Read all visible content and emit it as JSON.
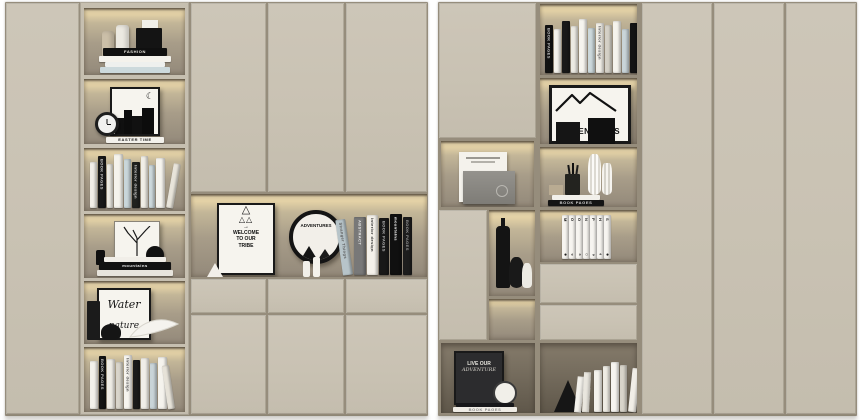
{
  "scene": {
    "background_color": "#ffffff",
    "cabinet_color": "#c9c2b3",
    "led_color": "#f0dcа4",
    "niche_back_color": "#a89d89",
    "dark_niche_color": "#6f6759",
    "book_black": "#161616",
    "book_white": "#f3f1ea",
    "book_blue": "#c7d4d8"
  },
  "left_unit": {
    "niche1": {
      "stack": [
        {
          "w": 64,
          "h": 8,
          "c": "#101010",
          "t": "FASHION",
          "tc": "#ece9e1"
        },
        {
          "w": 72,
          "h": 6,
          "c": "#f4f2ec"
        },
        {
          "w": 60,
          "h": 5,
          "c": "#eef0ee"
        },
        {
          "w": 70,
          "h": 6,
          "c": "#ccd9dc"
        }
      ]
    },
    "niche2": {
      "stack": [
        {
          "w": 58,
          "h": 6,
          "c": "#f3f1eb",
          "t": "EASTER TIME",
          "tc": "#1c1c1c"
        }
      ]
    },
    "niche3": {
      "books": [
        {
          "w": 7,
          "h": 46,
          "c": "#f2efe8"
        },
        {
          "w": 8,
          "h": 52,
          "c": "#191919",
          "t": "BOOK PAGES",
          "tc": "#cfcfcf"
        },
        {
          "w": 6,
          "h": 44,
          "c": "#eceae2"
        },
        {
          "w": 9,
          "h": 54,
          "c": "#f5f3ec"
        },
        {
          "w": 7,
          "h": 49,
          "c": "#c9d6da"
        },
        {
          "w": 8,
          "h": 46,
          "c": "#20221f",
          "t": "Interior design",
          "tc": "#d8d8d8"
        },
        {
          "w": 7,
          "h": 52,
          "c": "#f1eee6"
        },
        {
          "w": 6,
          "h": 43,
          "c": "#cdd9dc"
        },
        {
          "w": 9,
          "h": 50,
          "c": "#f6f4ee"
        },
        {
          "w": 7,
          "h": 45,
          "c": "#e8e4da",
          "lean": 10
        }
      ]
    },
    "niche4": {
      "stack": [
        {
          "w": 62,
          "h": 5,
          "c": "#f1eee8"
        },
        {
          "w": 72,
          "h": 8,
          "c": "#121212",
          "t": "mountains",
          "tc": "#f5f5f5"
        },
        {
          "w": 76,
          "h": 6,
          "c": "#e7e4dc"
        }
      ]
    },
    "niche5": {
      "art": {
        "line1": "Water",
        "line2": "nature"
      }
    },
    "niche6": {
      "books": [
        {
          "w": 8,
          "h": 48,
          "c": "#f3f1eb"
        },
        {
          "w": 7,
          "h": 53,
          "c": "#141414",
          "t": "BOOK PAGES",
          "tc": "#c9c9c9"
        },
        {
          "w": 8,
          "h": 50,
          "c": "#efece5"
        },
        {
          "w": 7,
          "h": 47,
          "c": "#d9d5cb"
        },
        {
          "w": 8,
          "h": 54,
          "c": "#f6f4ef",
          "t": "Interior design",
          "tc": "#444444"
        },
        {
          "w": 7,
          "h": 49,
          "c": "#1b1b1b"
        },
        {
          "w": 8,
          "h": 51,
          "c": "#f1eee8"
        },
        {
          "w": 7,
          "h": 46,
          "c": "#c9d4d8"
        },
        {
          "w": 9,
          "h": 52,
          "c": "#f5f3ed"
        },
        {
          "w": 7,
          "h": 44,
          "c": "#e6e2d8",
          "lean": -8
        }
      ]
    },
    "display_niche": {
      "poster": {
        "line1": "WELCOME",
        "line2": "TO OUR",
        "line3": "TRIBE"
      },
      "plate_label": "ADVENTURES",
      "books": [
        {
          "w": 10,
          "h": 56,
          "c": "#b7c4c9",
          "t": "Stranger Things",
          "tc": "#5a5a5a",
          "lean": -8
        },
        {
          "w": 12,
          "h": 58,
          "c": "#787878",
          "t": "ABSTRACT",
          "tc": "#e8e8e8"
        },
        {
          "w": 11,
          "h": 60,
          "c": "#f4f1ea",
          "t": "Interior design",
          "tc": "#333333"
        },
        {
          "w": 10,
          "h": 57,
          "c": "#181818",
          "t": "BOOK PAGES",
          "tc": "#bbbbbb"
        },
        {
          "w": 12,
          "h": 61,
          "c": "#101010",
          "t": "mountains",
          "tc": "#ffffff"
        },
        {
          "w": 9,
          "h": 58,
          "c": "#1d1d1d",
          "t": "BOOK PAGES",
          "tc": "#999999"
        }
      ]
    }
  },
  "right_unit": {
    "top_books": [
      {
        "w": 8,
        "h": 48,
        "c": "#131313",
        "t": "BOOK PAGES",
        "tc": "#cccccc"
      },
      {
        "w": 7,
        "h": 44,
        "c": "#f4f2ec"
      },
      {
        "w": 8,
        "h": 52,
        "c": "#191919"
      },
      {
        "w": 7,
        "h": 47,
        "c": "#eceae3"
      },
      {
        "w": 8,
        "h": 54,
        "c": "#f6f4ef"
      },
      {
        "w": 7,
        "h": 45,
        "c": "#ccd8db"
      },
      {
        "w": 8,
        "h": 50,
        "c": "#f1eee7",
        "t": "Interior design",
        "tc": "#555555"
      },
      {
        "w": 7,
        "h": 48,
        "c": "#d5d1c7"
      },
      {
        "w": 8,
        "h": 52,
        "c": "#f5f3ed"
      },
      {
        "w": 7,
        "h": 44,
        "c": "#c9d4d8"
      },
      {
        "w": 8,
        "h": 50,
        "c": "#141414"
      }
    ],
    "adventure_poster_label": "ADVENTURES",
    "vases_stack": [
      {
        "w": 48,
        "h": 5,
        "c": "#f2f0ea"
      },
      {
        "w": 56,
        "h": 6,
        "c": "#141414",
        "t": "BOOK PAGES",
        "tc": "#cfcfcf"
      }
    ],
    "moon_title": "MOON PHASES",
    "moon_books": [
      {
        "w": 7,
        "h": 44,
        "c": "#f7f5f0",
        "t": "M",
        "tc": "#1d1d1d",
        "sym": "●"
      },
      {
        "w": 7,
        "h": 44,
        "c": "#f7f5f0",
        "t": "O",
        "tc": "#1d1d1d",
        "sym": "◐"
      },
      {
        "w": 7,
        "h": 44,
        "c": "#f7f5f0",
        "t": "O",
        "tc": "#1d1d1d",
        "sym": "◑"
      },
      {
        "w": 7,
        "h": 44,
        "c": "#f7f5f0",
        "t": "N",
        "tc": "#1d1d1d",
        "sym": "○"
      },
      {
        "w": 7,
        "h": 44,
        "c": "#f7f5f0",
        "t": "P",
        "tc": "#1d1d1d",
        "sym": "◒"
      },
      {
        "w": 7,
        "h": 44,
        "c": "#f7f5f0",
        "t": "H",
        "tc": "#1d1d1d",
        "sym": "◓"
      },
      {
        "w": 7,
        "h": 44,
        "c": "#f7f5f0",
        "t": "S",
        "tc": "#1d1d1d",
        "sym": "●"
      }
    ],
    "bottom_left_art": {
      "line1": "LIVE OUR",
      "line2": "ADVENTURE"
    },
    "bottom_left_stack": [
      {
        "w": 58,
        "h": 4,
        "c": "#17171a"
      },
      {
        "w": 64,
        "h": 5,
        "c": "#efece5",
        "t": "BOOK PAGES",
        "tc": "#888888"
      }
    ],
    "bottom_right_books": [
      {
        "w": 8,
        "h": 42,
        "c": "#f4f2ec"
      },
      {
        "w": 7,
        "h": 46,
        "c": "#efece4"
      },
      {
        "w": 8,
        "h": 50,
        "c": "#f7f5f0"
      },
      {
        "w": 7,
        "h": 47,
        "c": "#d8d4ca"
      },
      {
        "w": 8,
        "h": 44,
        "c": "#f1eee7",
        "lean": 6
      }
    ]
  }
}
